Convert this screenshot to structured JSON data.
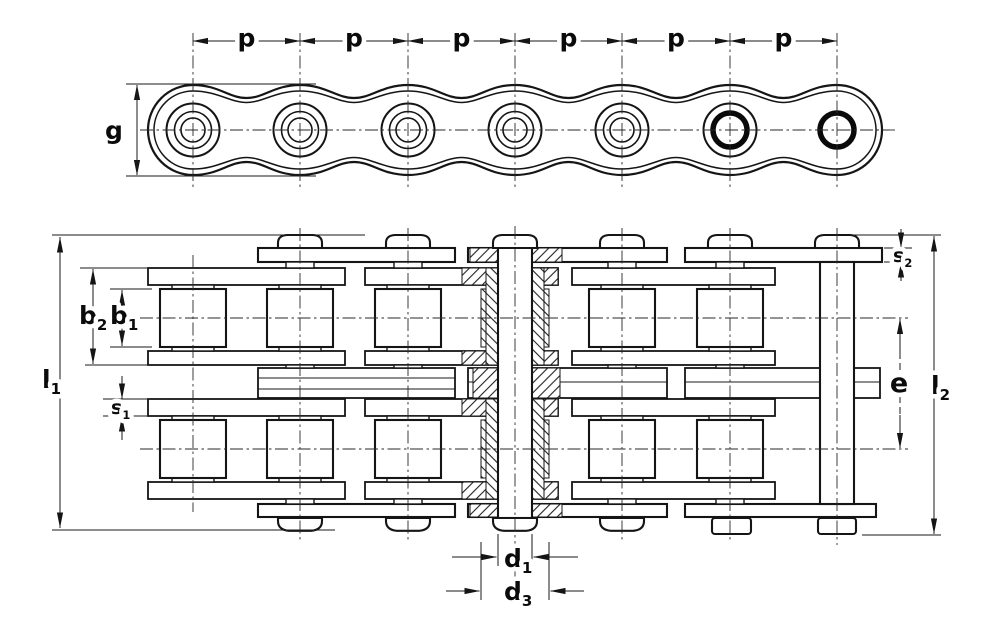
{
  "drawing": {
    "kind": "duplex roller chain dimension drawing",
    "ink_color": "#151515",
    "background_color": "#ffffff"
  },
  "labels": {
    "pitch": "p",
    "plate_height": "g",
    "b1": {
      "base": "b",
      "sub": "1"
    },
    "b2": {
      "base": "b",
      "sub": "2"
    },
    "l1": {
      "base": "l",
      "sub": "1"
    },
    "l2": {
      "base": "l",
      "sub": "2"
    },
    "s1": {
      "base": "s",
      "sub": "1"
    },
    "s2": {
      "base": "s",
      "sub": "2"
    },
    "e": "e",
    "d1": {
      "base": "d",
      "sub": "1"
    },
    "d3": {
      "base": "d",
      "sub": "3"
    }
  }
}
